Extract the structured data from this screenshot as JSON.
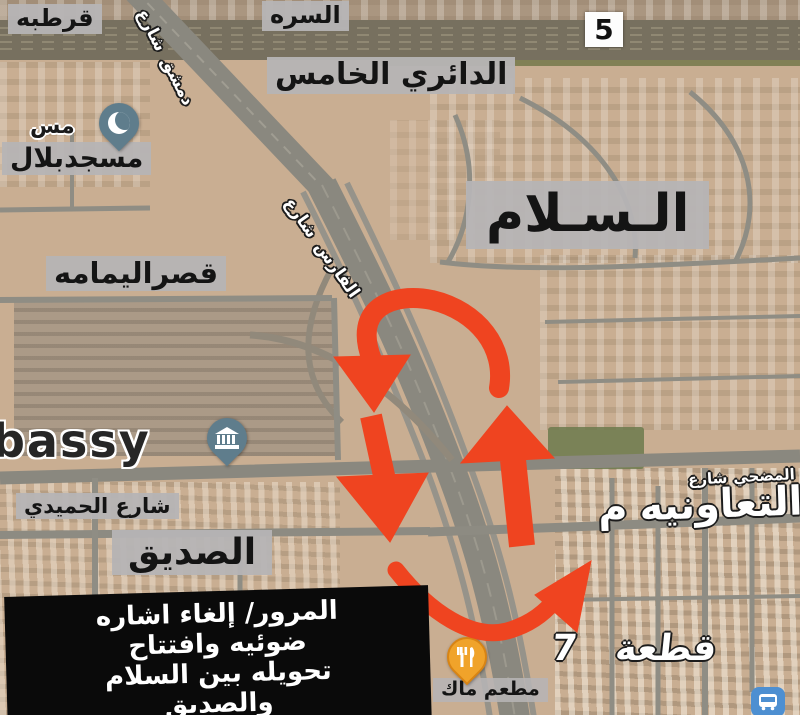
{
  "colors": {
    "arrow": "#ef4420",
    "label_bg": "#b6b4b5",
    "black_box": "#0a0a0a",
    "pin_blue": "#5f7d8c",
    "pin_amber": "#f0a32a",
    "bus_blue": "#4d8fd1"
  },
  "map_labels": {
    "qurtuba": "قرطبه",
    "surra": "السره",
    "ring_road_badge": "5",
    "fifth_ring_road": "الدائري الخامس",
    "mosque_partial": "مس",
    "bilal_mosque": "مسجدبلال",
    "salam_district": "الـسـلام",
    "qasr_yamama": "قصراليمامه",
    "embassy_partial": "bassy",
    "damascus_street_w1": "شارع",
    "damascus_street_w2": "دمشق",
    "faris_street_w1": "شارع",
    "faris_street_w2": "الفارس",
    "humaidi_street": "شارع الحميدي",
    "siddiq_district": "الصديق",
    "mudhahi_street_w1": "شارع",
    "mudhahi_street_w2": "المضحي",
    "coop_partial_w1": "م",
    "coop_partial_w2": "التعاونيه",
    "block7": "قطعة 7",
    "restaurant": "مطعم ماك"
  },
  "info_box": {
    "lines": [
      "المرور/ إلغاء اشاره",
      "ضوئيه وافتتاح",
      "تحويله بين السلام",
      "والصديق"
    ]
  },
  "icons": {
    "mosque_pin": "crescent-mosque-pin",
    "embassy_pin": "government-building-pin",
    "restaurant_pin": "fork-knife-pin",
    "bus_badge": "bus-transit-icon"
  }
}
